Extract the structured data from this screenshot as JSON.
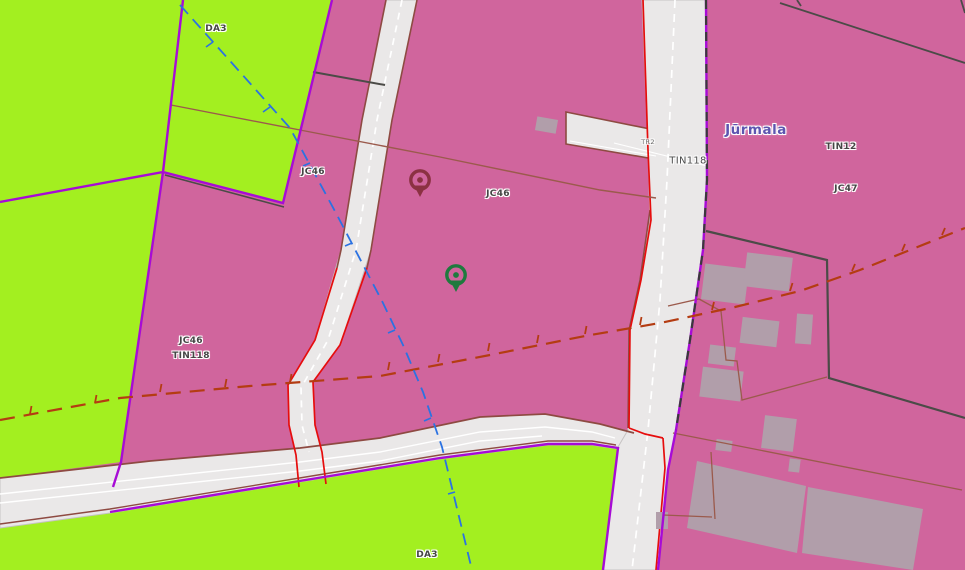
{
  "map": {
    "city_label": "Jūrmala",
    "zone_labels": [
      {
        "id": "da3-north",
        "text": "DA3"
      },
      {
        "id": "jc46-upper-west",
        "text": "JC46"
      },
      {
        "id": "jc46-center",
        "text": "JC46"
      },
      {
        "id": "tin118-road",
        "text": "TIN118"
      },
      {
        "id": "tr2-road",
        "text": "TR2"
      },
      {
        "id": "tin12-east",
        "text": "TIN12"
      },
      {
        "id": "jc47-east",
        "text": "JC47"
      },
      {
        "id": "jc46-southwest",
        "text": "JC46"
      },
      {
        "id": "tin118-southwest",
        "text": "TIN118"
      },
      {
        "id": "da3-south",
        "text": "DA3"
      }
    ],
    "markers": [
      {
        "id": "location-pin-maroon",
        "color": "#8b3142"
      },
      {
        "id": "location-pin-green",
        "color": "#1e7a3e"
      }
    ],
    "colors": {
      "zone_pink": "#d0659d",
      "zone_green": "#a3ef20",
      "road_fill": "#eae8e8",
      "road_casing": "#c6c3c3",
      "boundary_purple": "#a70bd6",
      "admin_line_blue": "#2b72e2",
      "utility_dashed_red": "#b43c12",
      "road_edge_maroon": "#8e4a42",
      "edge_bright_red": "#e60d0d",
      "building_fill": "#b19eaa",
      "cadastre_line_dark": "#4b4b47",
      "parcel_line_brown": "#9b5a4c",
      "city_label_color": "#5d55b0"
    }
  }
}
